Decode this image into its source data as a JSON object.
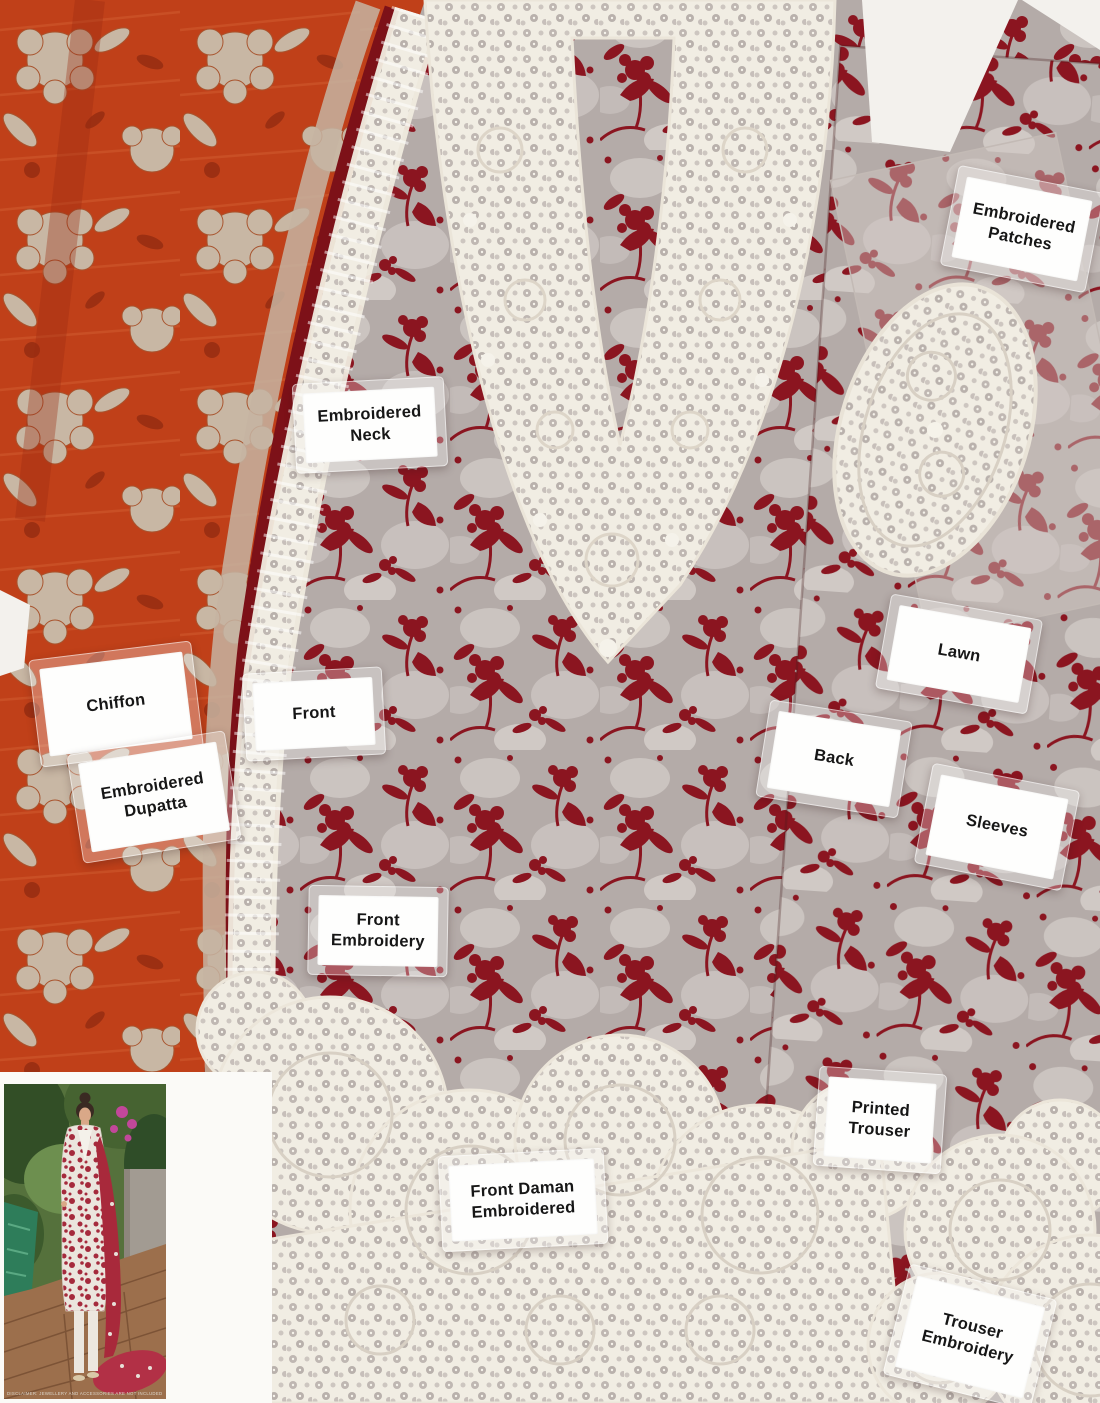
{
  "labels": {
    "embroidered_patches": "Embroidered\nPatches",
    "embroidered_neck": "Embroidered\nNeck",
    "chiffon": "Chiffon",
    "embroidered_dupatta": "Embroidered\nDupatta",
    "front": "Front",
    "lawn": "Lawn",
    "back": "Back",
    "sleeves": "Sleeves",
    "front_embroidery": "Front\nEmbroidery",
    "printed_trouser": "Printed\nTrouser",
    "front_daman_embroidered": "Front Daman\nEmbroidered",
    "trouser_embroidery": "Trouser\nEmbroidery"
  },
  "inset_photo": {
    "caption": "DISCLAIMER: JEWELLERY AND ACCESSORIES ARE NOT INCLUDED"
  },
  "colors": {
    "maroon_print": "#8b1520",
    "chiffon_red": "#c04019",
    "fabric_grey": "#b4aba8",
    "lace_white": "#f1ede3",
    "background": "#f3f1ed",
    "label_background": "#fefefd",
    "label_text": "#161616"
  }
}
